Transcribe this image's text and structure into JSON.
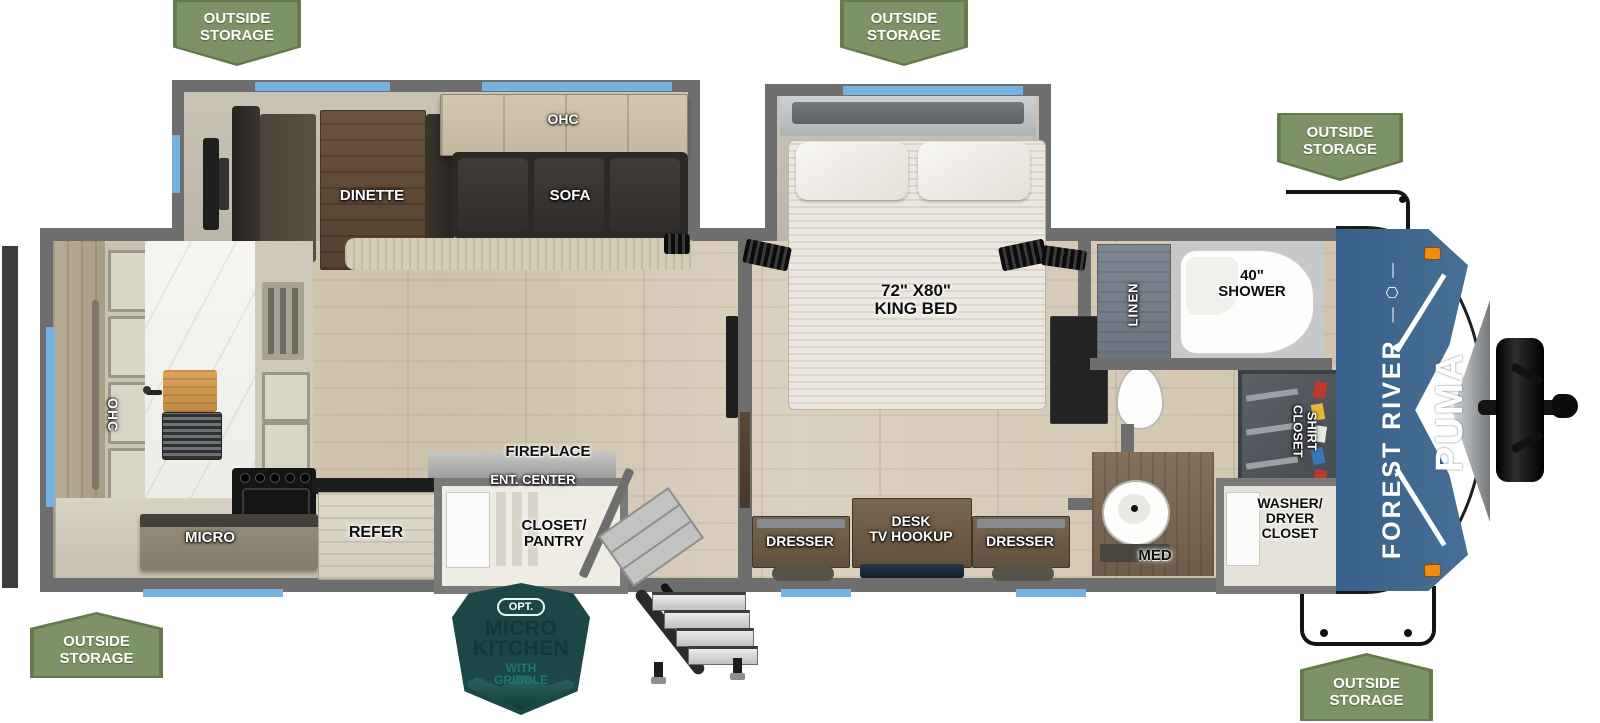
{
  "badges": {
    "outside_storage": "OUTSIDE\nSTORAGE"
  },
  "labels": {
    "dinette": "DINETTE",
    "ohc_slide": "OHC",
    "sofa": "SOFA",
    "king_bed": "72\" X80\"\nKING BED",
    "linen": "LINEN",
    "shower": "40\"\nSHOWER",
    "shirt_closet": "SHIRT\nCLOSET",
    "med": "MED",
    "washer_dryer": "WASHER/\nDRYER\nCLOSET",
    "dresser_left": "DRESSER",
    "desk_tv": "DESK\nTV HOOKUP",
    "dresser_right": "DRESSER",
    "fireplace": "FIREPLACE",
    "ent_center": "ENT. CENTER",
    "closet_pantry": "CLOSET/\nPANTRY",
    "refer": "REFER",
    "micro": "MICRO",
    "ohc_kitchen": "OHC"
  },
  "branding": {
    "manufacturer": "FOREST RIVER",
    "emblem": "—  ⬡  —",
    "model": "PUMA"
  },
  "option_badge": {
    "tag": "OPT.",
    "title": "MICRO\nKITCHEN",
    "subtitle": "WITH\nGRIDDLE"
  },
  "colors": {
    "badge_green": "#7d9267",
    "window_blue": "#74b2e2",
    "wall_gray": "#6e6e6e",
    "cap_blue": "#3f6990",
    "teal_dark": "#1c4747",
    "teal_accent": "#1c7a6e",
    "flame_orange": "#e8590c",
    "ent_strip_blue": "#3a62c4"
  }
}
